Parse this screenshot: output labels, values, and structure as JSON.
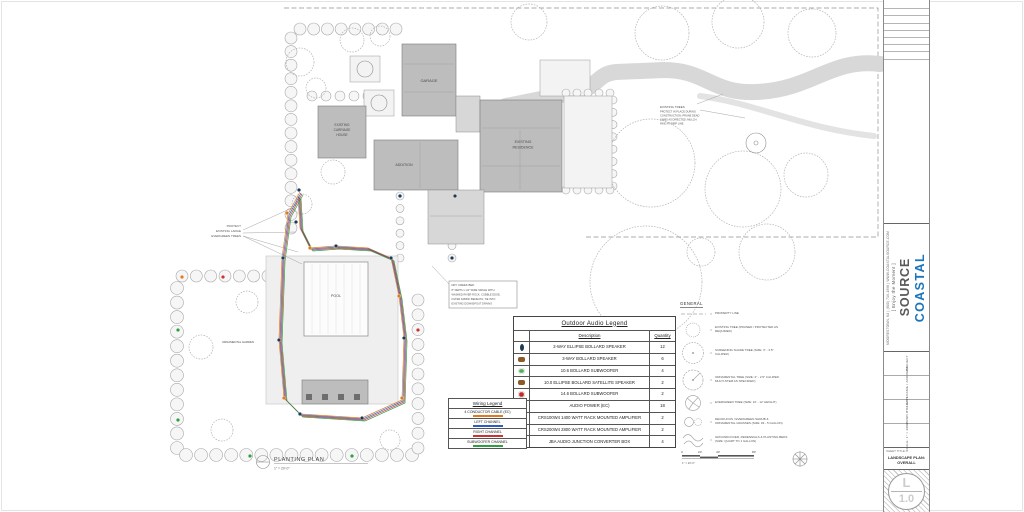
{
  "plan": {
    "labels": {
      "garage": "GARAGE",
      "addition": "ADDITION",
      "residence_line1": "EXISTING",
      "residence_line2": "RESIDENCE",
      "carriage_line1": "EXISTING",
      "carriage_line2": "CARRIAGE",
      "carriage_line3": "HOUSE",
      "pool": "POOL",
      "garden": "ORNAMENTAL GARDEN"
    },
    "notes": {
      "evergreens": [
        "PROTECT",
        "EXISTING LARGE",
        "EVERGREEN TREES"
      ],
      "dry_creek": [
        "DRY CREEK BED",
        "8\" DEPTH x 24\" WIDE SWALE WITH",
        "WASHED RIVER ROCK, COBBLE EDGE,",
        "FILTER FABRIC BENEATH; TIE INTO",
        "EXISTING DOWNSPOUT DRAINS"
      ],
      "existing_trees": [
        "EXISTING TREES",
        "PROTECT IN PLACE DURING",
        "CONSTRUCTION; PRUNE DEAD",
        "LIMBS AS DIRECTED; MULCH",
        "RING AT DRIP LINE"
      ]
    },
    "title": {
      "label": "PLANTING PLAN",
      "scale": "1\" = 20'-0\""
    },
    "scale_bar": {
      "ticks": [
        "0",
        "20'",
        "40'",
        "80'"
      ],
      "note": "1\" = 20'-0\""
    }
  },
  "audio_legend": {
    "title": "Outdoor Audio Legend",
    "columns": {
      "description": "Description",
      "quantity": "Quantity"
    },
    "rows": [
      {
        "icon": "2way-ellipse-bollard-speaker-icon",
        "icon_color": "#1c3a57",
        "description": "2-WAY ELLIPSE BOLLARD SPEAKER",
        "quantity": "12"
      },
      {
        "icon": "3way-bollard-speaker-icon",
        "icon_color": "#8a5a28",
        "description": "3-WAY BOLLARD SPEAKER",
        "quantity": "6"
      },
      {
        "icon": "bollard-subwoofer-10-icon",
        "icon_color": "#4caf50",
        "description": "10.6 BOLLARD SUBWOOFER",
        "quantity": "4"
      },
      {
        "icon": "ellipse-bollard-satellite-icon",
        "icon_color": "#8a5a28",
        "description": "10.0 ELLIPSE BOLLARD SATELLITE SPEAKER",
        "quantity": "2"
      },
      {
        "icon": "bollard-subwoofer-14-icon",
        "icon_color": "#c62828",
        "description": "14.6 BOLLARD SUBWOOFER",
        "quantity": "2"
      },
      {
        "icon": "audio-power-icon",
        "icon_color": "#444444",
        "description": "AUDIO POWER (EC)",
        "quantity": "18"
      },
      {
        "icon": "rack-amplifier-icon",
        "icon_color": "#1a1a1a",
        "description": "CRS100W4 1400 WATT RACK MOUNTED AMPLIFIER",
        "quantity": "2"
      },
      {
        "icon": "rack-amplifier-icon",
        "icon_color": "#1a1a1a",
        "description": "CRS200W4 2800 WATT RACK MOUNTED AMPLIFIER",
        "quantity": "2"
      },
      {
        "icon": "junction-box-icon",
        "icon_color": "#dcdcdc",
        "description": "JBA AUDIO JUNCTION CONVERTER BOX",
        "quantity": "4"
      }
    ]
  },
  "wiring_legend": {
    "title": "Wiring Legend",
    "rows": [
      {
        "label": "4 CONDUCTOR CABLE (EC)",
        "color": "#e07a20"
      },
      {
        "label": "LEFT CHANNEL",
        "color": "#2b5fc7"
      },
      {
        "label": "RIGHT CHANNEL",
        "color": "#cc3333"
      },
      {
        "label": "SUBWOOFER CHANNEL",
        "color": "#2f9e44"
      }
    ]
  },
  "general_legend": {
    "title": "GENERAL",
    "separator": "=",
    "rows": [
      {
        "symbol": "property-line-symbol",
        "label": "PROPERTY LINE"
      },
      {
        "symbol": "existing-tree-symbol",
        "label": "EXISTING TREE (PRUNED / PROTECTED AS REQUIRED)"
      },
      {
        "symbol": "shade-tree-symbol",
        "label": "SCREENING SHADE TREE (SIZE: 3\" - 3.5\" CALIPER)"
      },
      {
        "symbol": "ornamental-tree-symbol",
        "label": "ORNAMENTAL TREE (SIZE: 2\" - 2.5\" CALIPER, MULTI-STEM AS SPECIFIED)"
      },
      {
        "symbol": "evergreen-tree-symbol",
        "label": "EVERGREEN TREE (SIZE: 10' - 12' HEIGHT)"
      },
      {
        "symbol": "shrub-symbol",
        "label": "DECIDUOUS / EVERGREEN SHRUB & ORNAMENTAL GRASSES (SIZE: #3 - 5 GALLON)"
      },
      {
        "symbol": "groundcover-symbol",
        "label": "GROUNDCOVER, PERENNIALS & PLANTING BEDS (SIZE: QUART TO 1 GALLON)"
      }
    ]
  },
  "title_block": {
    "brand_primary": "COASTAL",
    "brand_secondary": "SOURCE",
    "brand_primary_color": "#1b75bc",
    "tagline": "[ Enjoy the Moment ]",
    "contact": "MOORESTOWN, NJ  |  (800) 719-1996  |  WWW.COASTALSOURCE.COM",
    "fields": [
      "PROJECT",
      "CLIENT NAME / ADDRESS",
      "DRAWN BY / DATE",
      "SCALE: 1\" = 20'-0\""
    ],
    "sheet_title_label": "SHEET TITLE:",
    "sheet_title": "LANDSCAPE PLAN: OVERALL",
    "badge_letter": "L",
    "badge_number": "1.0"
  }
}
